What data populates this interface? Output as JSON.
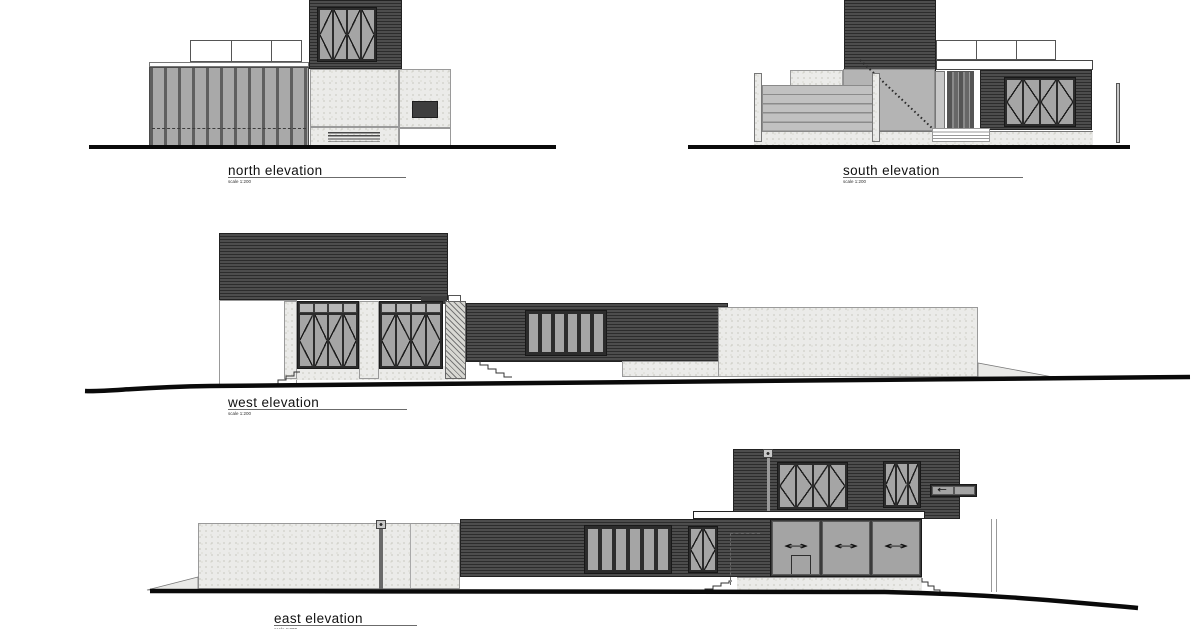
{
  "elevations": {
    "north": {
      "label": "north elevation",
      "scale": "scale 1:200"
    },
    "south": {
      "label": "south elevation",
      "scale": "scale 1:200"
    },
    "west": {
      "label": "west elevation",
      "scale": "scale 1:200"
    },
    "east": {
      "label": "east elevation",
      "scale": "scale 1:200"
    }
  },
  "icons": {
    "slide_arrow": "↔",
    "slide_arrow_left": "←"
  },
  "colors": {
    "cladding": "#3f3f3f",
    "cladding_line": "#2a2a2a",
    "concrete": "#ebebe9",
    "glass": "#a5a5a5",
    "frame": "#2c2c2c",
    "ground_line": "#0a0a0a"
  }
}
